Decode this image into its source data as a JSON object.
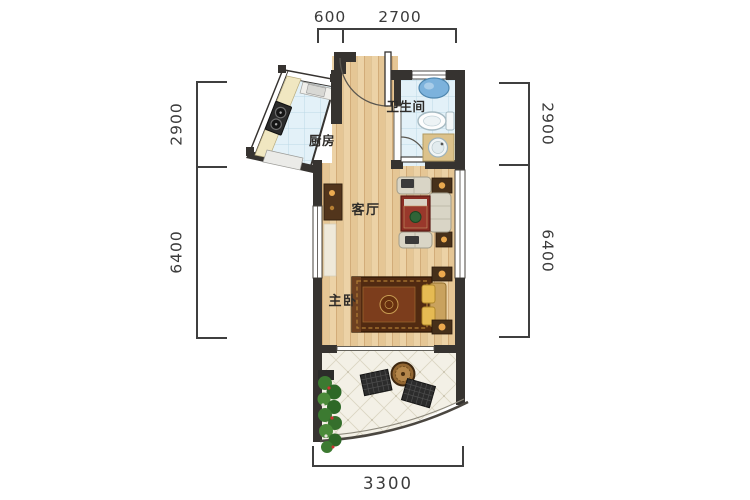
{
  "plan": {
    "rooms": {
      "kitchen": "厨房",
      "bathroom": "卫生间",
      "living_room": "客厅",
      "master_bedroom": "主卧"
    },
    "dimensions_mm": {
      "top_left": "600",
      "top_right": "2700",
      "left_upper": "2900",
      "left_lower": "6400",
      "right_upper": "2900",
      "right_lower": "6400",
      "bottom": "3300"
    },
    "colors": {
      "wall": "#363330",
      "wood_floor": "#ecd2a6",
      "tile_floor": "#e3f1f8",
      "balcony_floor": "#f3f0e6",
      "dimension_line": "#3f3f3f",
      "accent_bed": "#512a11",
      "accent_sofa": "#d9d5c6"
    }
  }
}
